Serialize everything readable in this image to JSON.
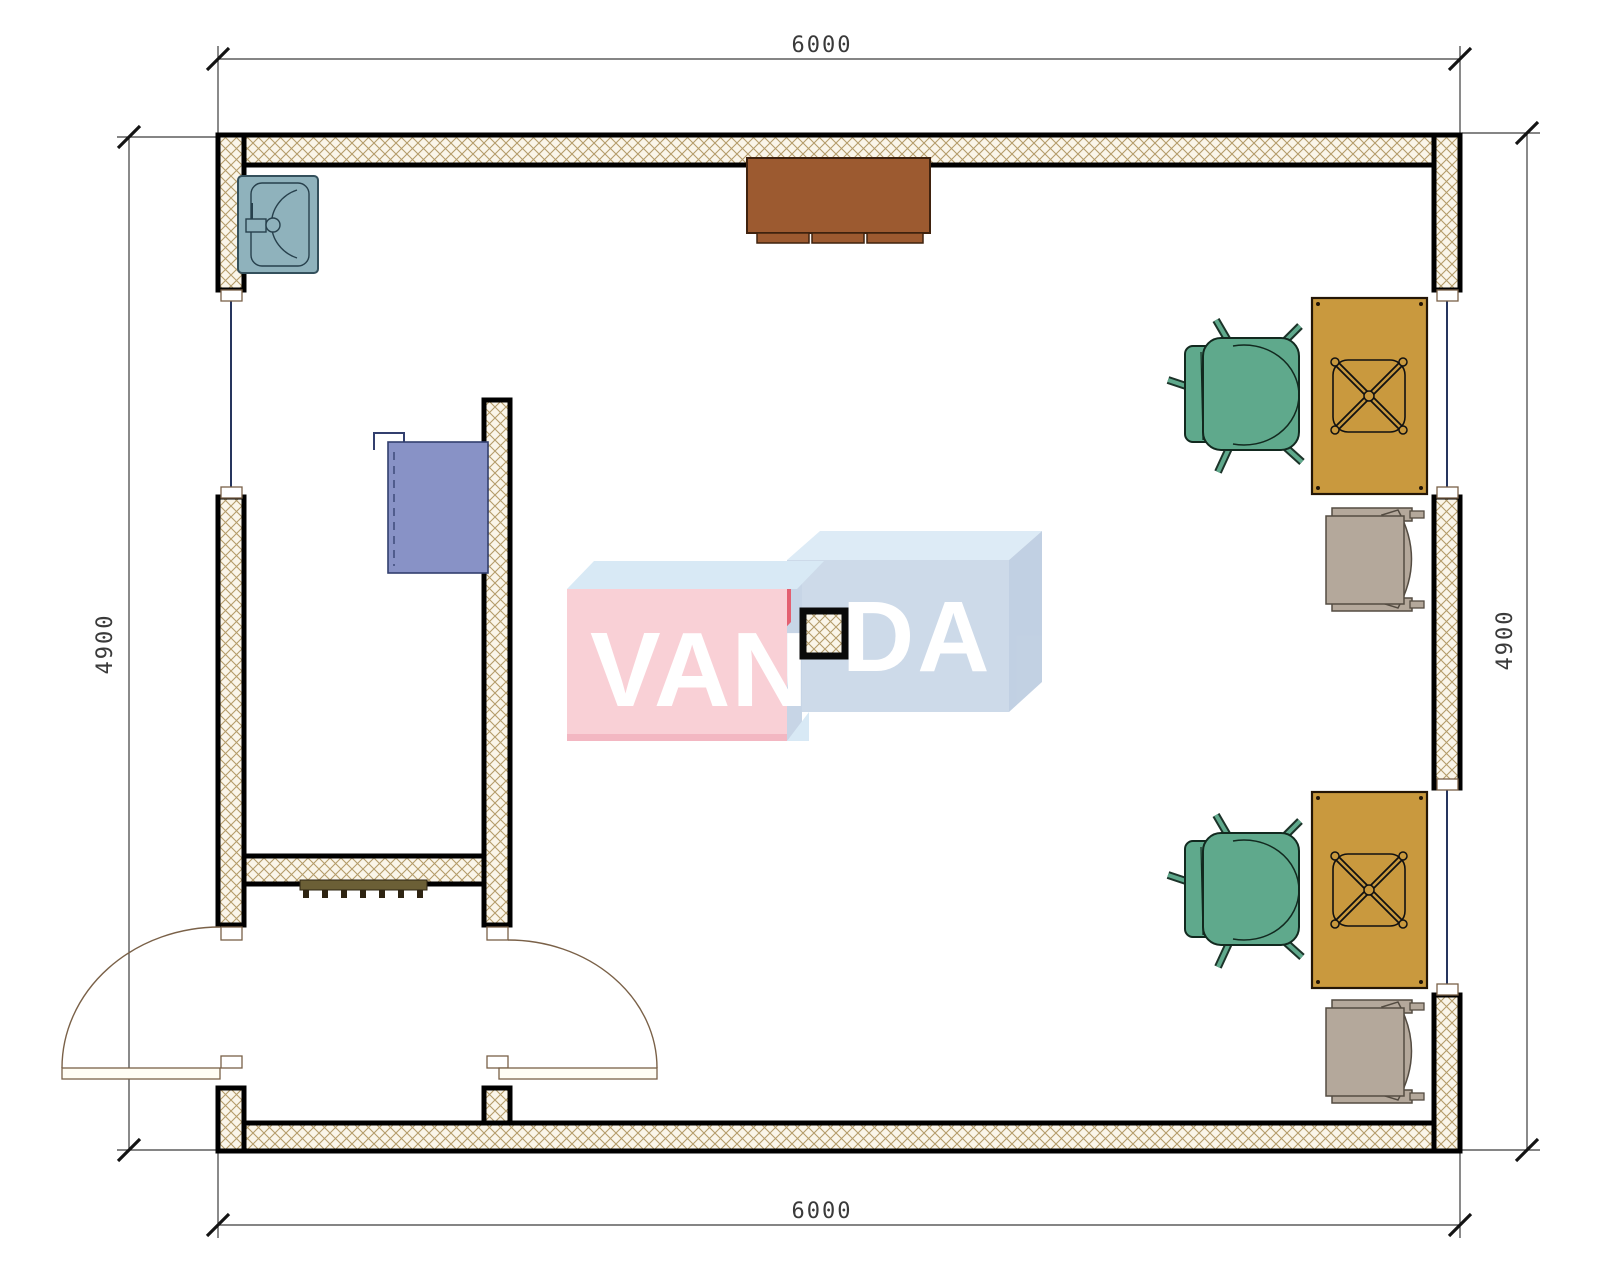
{
  "plan": {
    "dimensions": {
      "top": "6000",
      "bottom": "6000",
      "left": "4900",
      "right": "4900"
    },
    "watermark": {
      "left": "VAN",
      "right": "DA"
    },
    "colors": {
      "wall_line": "#000000",
      "hatch_line": "#b49c6a",
      "hatch_bg": "#faf5e9",
      "sink": "#8fb2bc",
      "side_table": "#9c5a30",
      "cabinet": "#8892c6",
      "armchair": "#5fa98c",
      "desk": "#c9993e",
      "office_chair": "#b4a89b",
      "radiator": "#6b5f36",
      "door": "#7a6148",
      "dimension_text": "#3a3a3a",
      "watermark_pink": "#f9cfd5",
      "watermark_blue_front": "#ccd9e9",
      "watermark_light_blue_top": "#d7e9f5",
      "watermark_red_accent": "#e25a6c"
    },
    "symbols": [
      "exterior-wall",
      "window",
      "entrance-door",
      "sink",
      "side-table",
      "wall-cabinet",
      "radiator",
      "structural-column",
      "armchair",
      "desk",
      "office-chair-base"
    ]
  }
}
